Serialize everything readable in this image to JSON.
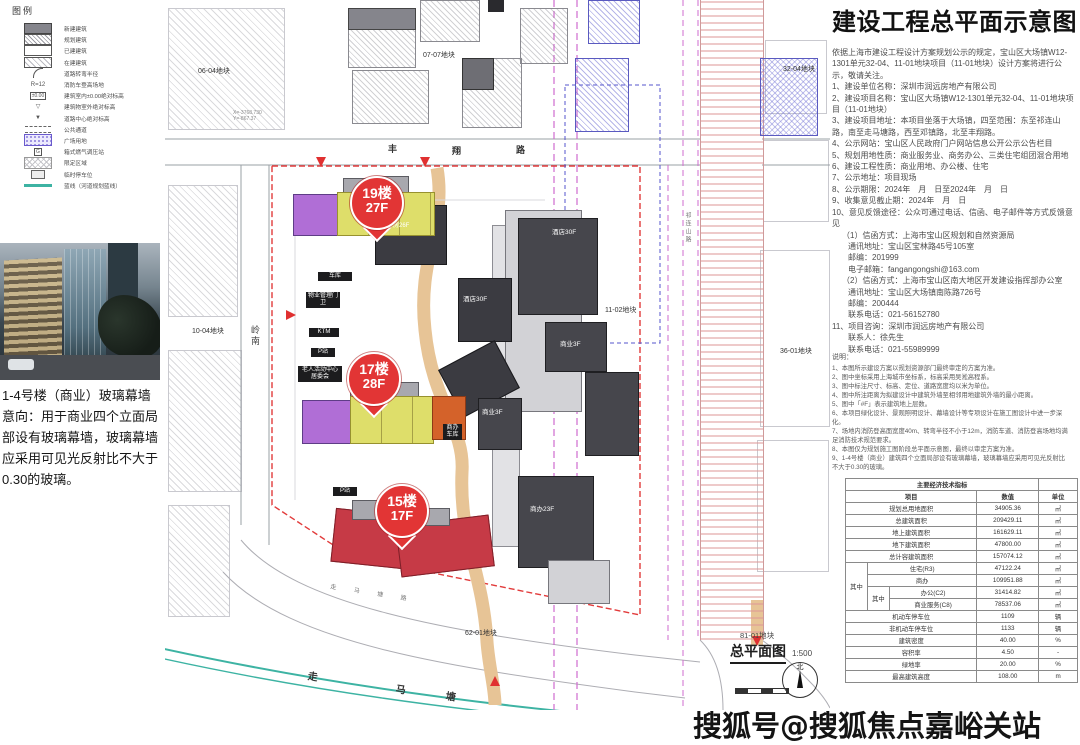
{
  "legend": {
    "title": "图例",
    "items": [
      {
        "label": "新建建筑"
      },
      {
        "label": "规划建筑"
      },
      {
        "label": "已建建筑"
      },
      {
        "label": "在建建筑"
      },
      {
        "label": "道路转弯半径"
      },
      {
        "label": "消防车登高场地",
        "glyph": "R=12"
      },
      {
        "label": "建筑室内±0.00绝对标高",
        "glyph": "±0.00"
      },
      {
        "label": "建筑物室外绝对标高",
        "glyph": "▽"
      },
      {
        "label": "道路中心绝对标高",
        "glyph": "▼"
      },
      {
        "label": "公共通道"
      },
      {
        "label": "广场用地"
      },
      {
        "label": "箱式燃气调压站",
        "glyph": "G"
      },
      {
        "label": "限定区域"
      },
      {
        "label": "临时停车位"
      },
      {
        "label": "蓝线（河道规划蓝线）"
      }
    ]
  },
  "photo_caption": "1-4号楼（商业）玻璃幕墙意向：用于商业四个立面局部设有玻璃幕墙，玻璃幕墙应采用可见光反射比不大于0.30的玻璃。",
  "plan": {
    "parcel_labels": {
      "p0604": "06-04地块",
      "p0707": "07-07地块",
      "p3204": "32-04地块",
      "p1004": "10-04地块",
      "p3601": "36-01地块",
      "p1102": "11-02地块",
      "p6201": "62-01地块"
    },
    "road_labels": {
      "north_1": "丰",
      "north_2": "翔",
      "north_3": "路",
      "river_1": "走",
      "river_2": "马",
      "river_3": "塘",
      "south_road": "走 马 塘 路",
      "west_vertical": "岭南",
      "east_vertical": "祁连山路"
    },
    "building_labels": {
      "hotel_n": "酒店30F",
      "hotel_w": "酒店30F",
      "biz_e": "商业3F",
      "biz_w": "商业3F",
      "office_s": "商办23F",
      "club": "保障房26F",
      "garage": "车库",
      "pm": "物业管理门卫",
      "ktm": "KTM",
      "p1": "P站",
      "p2": "P站",
      "senior": "老人活动中心居委会",
      "biz_garage": "商办车库"
    },
    "pins": [
      {
        "l1": "19楼",
        "l2": "27F"
      },
      {
        "l1": "17楼",
        "l2": "28F"
      },
      {
        "l1": "15楼",
        "l2": "17F"
      }
    ],
    "coords": "X=-3768.730\nY=-867.37",
    "title_block": {
      "parcel": "81-01地块",
      "title": "总平面图",
      "scale": "1:500",
      "north": "北"
    }
  },
  "panel": {
    "title": "建设工程总平面示意图",
    "lines": [
      "依据上海市建设工程设计方案规划公示的规定，宝山区大场镇W12-1301单元32-04、11-01地块项目（11-01地块）设计方案将进行公示，敬请关注。",
      "1、建设单位名称：深圳市润远房地产有限公司",
      "2、建设项目名称：宝山区大场镇W12-1301单元32-04、11-01地块项目（11-01地块）",
      "3、建设项目地址：本项目坐落于大场镇，四至范围：东至祁连山路，南至走马塘路，西至邓镇路，北至丰翔路。",
      "4、公示网站：宝山区人民政府门户网站信息公开公示公告栏目",
      "5、规划用地性质：商业服务业、商务办公、三类住宅组团混合用地",
      "6、建设工程性质：商业用地、办公楼、住宅",
      "7、公示地址：项目现场",
      "8、公示期限：2024年　月　日至2024年　月　日",
      "9、收集意见截止期：2024年　月　日",
      "10、意见反馈途径：公众可通过电话、信函、电子邮件等方式反馈意见",
      "（1）信函方式：上海市宝山区规划和自然资源局",
      "通讯地址：宝山区宝林路45号105室",
      "邮编：201999",
      "电子邮箱：fangangongshi@163.com",
      "（2）信函方式：上海市宝山区南大地区开发建设指挥部办公室",
      "通讯地址：宝山区大场镇南陈路726号",
      "邮编：200444",
      "联系电话：021-56152780",
      "11、项目咨询：深圳市润远房地产有限公司",
      "联系人：徐先生",
      "联系电话：021-55989999"
    ],
    "notes_title": "说明：",
    "notes": [
      "1、本图所示建设方案以规划资源部门最终审定的方案为准。",
      "2、图中坐标采用上海城市坐标系，标高采用吴淞高程系。",
      "3、图中标注尺寸、标高、定位、道路宽度均以米为单位。",
      "4、图中所注距离为拟建设计中建筑外墙至相邻用地建筑外墙的最小距离。",
      "5、图中「#F」表示建筑地上层数。",
      "6、本项目绿化设计、景观照明设计、幕墙设计等专项设计在施工图设计中进一步深化。",
      "7、场地内消防登高面宽度40m、转弯半径不小于12m，消防车道、消防登高场地均满足消防技术规范要求。",
      "8、本图仅为规划施工图阶段总平面示意图，最终以审定方案为准。",
      "9、1-4号楼（商业）建筑四个立面局部设有玻璃幕墙，玻璃幕墙应采用可见光反射比不大于0.30的玻璃。"
    ]
  },
  "table": {
    "title": "主要经济技术指标",
    "header": {
      "item": "项目",
      "value": "数值",
      "unit": "单位"
    },
    "group1": "其中",
    "group2": "其中",
    "rows": [
      {
        "label": "规划总用地面积",
        "value": "34905.36",
        "unit": "㎡"
      },
      {
        "label": "总建筑面积",
        "value": "209429.11",
        "unit": "㎡"
      },
      {
        "label": "地上建筑面积",
        "value": "161629.11",
        "unit": "㎡"
      },
      {
        "label": "地下建筑面积",
        "value": "47800.00",
        "unit": "㎡"
      },
      {
        "label": "总计容建筑面积",
        "value": "157074.12",
        "unit": "㎡"
      },
      {
        "label": "住宅(R3)",
        "value": "47122.24",
        "unit": "㎡"
      },
      {
        "label": "商办",
        "value": "109951.88",
        "unit": "㎡"
      },
      {
        "label": "办公(C2)",
        "value": "31414.82",
        "unit": "㎡"
      },
      {
        "label": "商业服务(C8)",
        "value": "78537.06",
        "unit": "㎡"
      },
      {
        "label": "机动车停车位",
        "value": "1109",
        "unit": "辆"
      },
      {
        "label": "非机动车停车位",
        "value": "1133",
        "unit": "辆"
      },
      {
        "label": "建筑密度",
        "value": "40.00",
        "unit": "%"
      },
      {
        "label": "容积率",
        "value": "4.50",
        "unit": "-"
      },
      {
        "label": "绿地率",
        "value": "20.00",
        "unit": "%"
      },
      {
        "label": "最高建筑高度",
        "value": "108.00",
        "unit": "m"
      }
    ]
  },
  "watermark": "搜狐号@搜狐焦点嘉峪关站"
}
